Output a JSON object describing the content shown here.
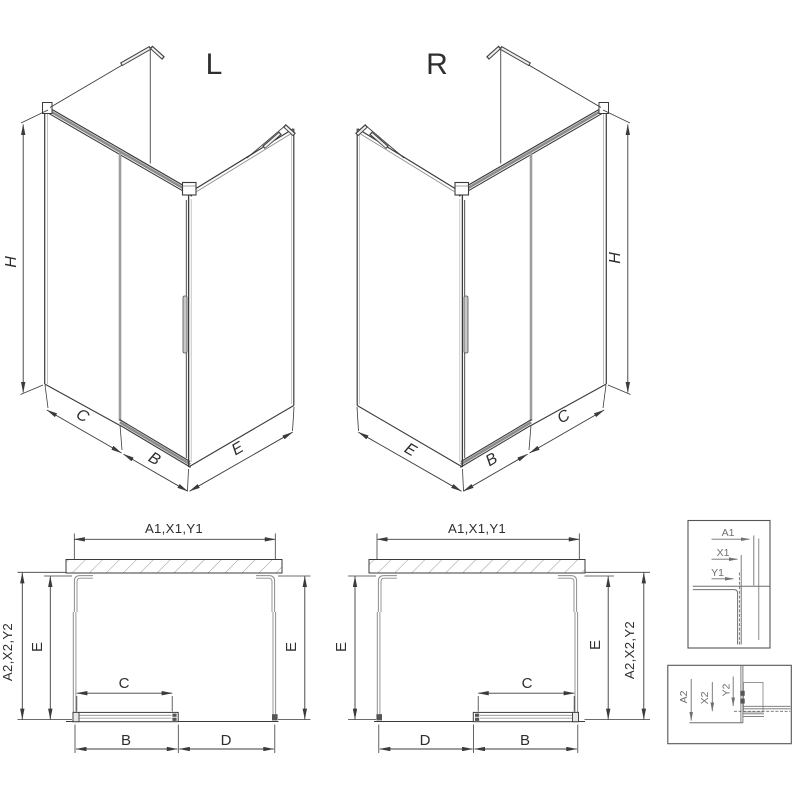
{
  "iso_left": {
    "label": "L",
    "dim_height": "H",
    "dim_fixed_side": "C",
    "dim_door": "B",
    "dim_return_panel": "E"
  },
  "iso_right": {
    "label": "R",
    "dim_height": "H",
    "dim_fixed_side": "C",
    "dim_door": "B",
    "dim_return_panel": "E"
  },
  "plan_left": {
    "dim_width_top": "A1,X1,Y1",
    "dim_depth_outer": "A2,X2,Y2",
    "dim_depth_left": "E",
    "dim_depth_right": "E",
    "dim_door_panel": "C",
    "dim_door_bottom": "B",
    "dim_opening": "D"
  },
  "plan_right": {
    "dim_width_top": "A1,X1,Y1",
    "dim_depth_outer": "A2,X2,Y2",
    "dim_depth_left": "E",
    "dim_depth_right": "E",
    "dim_door_panel": "C",
    "dim_door_bottom": "B",
    "dim_opening": "D"
  },
  "detail_top_profile": {
    "dim_a": "A1",
    "dim_x": "X1",
    "dim_y": "Y1"
  },
  "detail_bottom_track": {
    "dim_a": "A2",
    "dim_x": "X2",
    "dim_y": "Y2"
  },
  "colors": {
    "line_dark": "#3b3b3b",
    "line_mid": "#8c8c8c",
    "line_light": "#b8b8b8",
    "hatch": "#9a9a9a",
    "detail_text": "#6f6f6f",
    "background": "#ffffff"
  }
}
